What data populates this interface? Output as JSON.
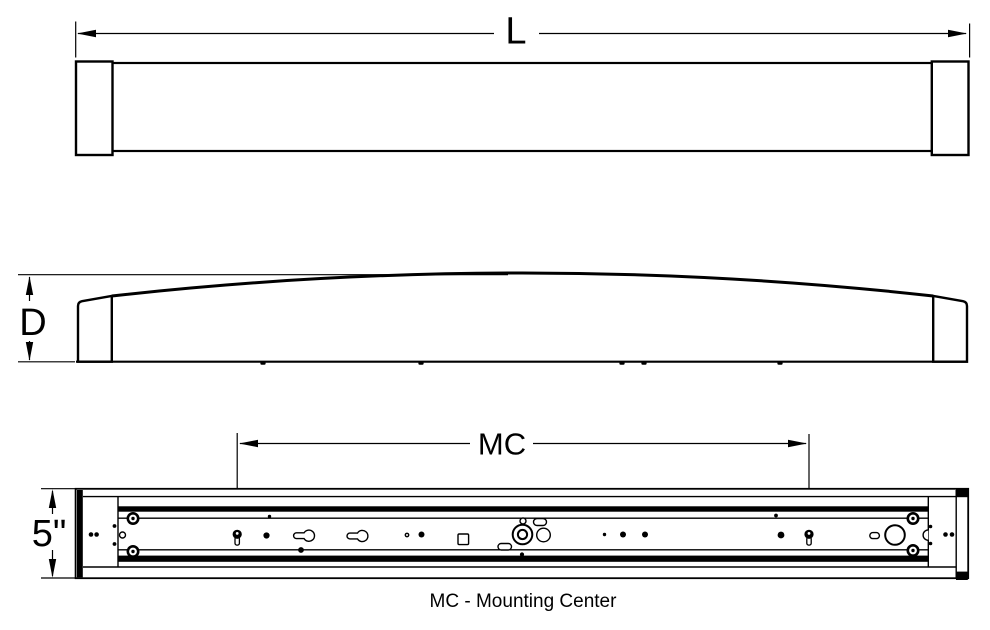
{
  "drawing": {
    "labels": {
      "length": "L",
      "depth": "D",
      "height": "5\"",
      "mounting_center": "MC"
    },
    "caption": "MC - Mounting Center",
    "colors": {
      "line": "#000000",
      "background": "#ffffff"
    }
  }
}
